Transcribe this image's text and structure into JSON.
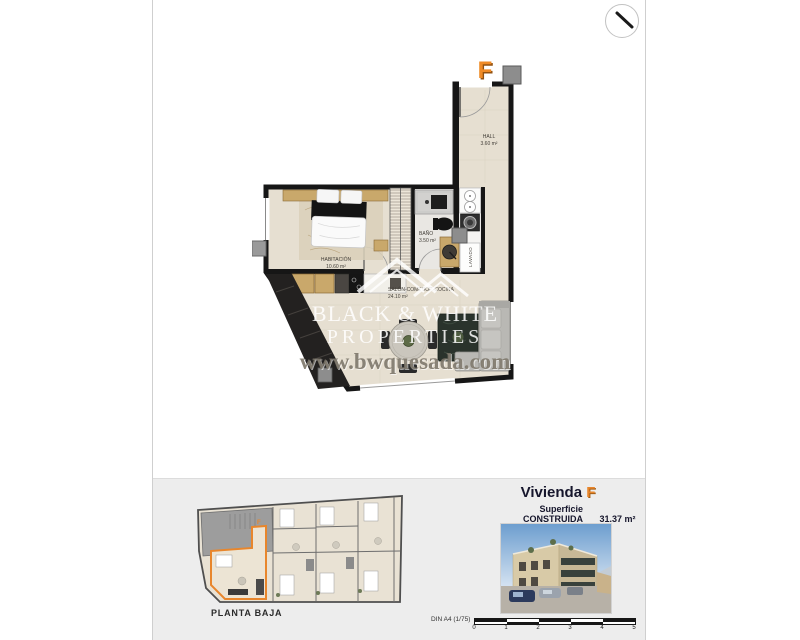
{
  "header": {
    "compass_icon": "north-arrow-icon"
  },
  "plan": {
    "unit_letter": "F",
    "rooms": {
      "hall": {
        "name": "HALL",
        "area": "3.60 m²"
      },
      "bano": {
        "name": "BAÑO",
        "area": "3.50 m²"
      },
      "habitacion": {
        "name": "HABITACIÓN",
        "area": "10.60 m²"
      },
      "salon": {
        "name": "SALÓN-COMEDOR-COCINA",
        "area": "24.10 m²"
      },
      "lavado": {
        "name": "LAVADO"
      }
    }
  },
  "watermark": {
    "brand_line1": "BLACK & WHITE",
    "brand_line2": "PROPERTIES",
    "website": "www.bwquesada.com"
  },
  "footer": {
    "floor_label": "PLANTA BAJA",
    "unit_name": "Vivienda",
    "unit_letter": "F",
    "surface_label": "Superficie CONSTRUIDA",
    "surface_value": "31.37 m²",
    "sheet_label": "DIN A4 (1/75)",
    "scale_ticks": [
      "0",
      "1",
      "2",
      "3",
      "4",
      "5"
    ]
  },
  "colors": {
    "accent_orange": "#e8862c",
    "wall": "#161616",
    "floor": "#e6dfd1",
    "panel_bg": "#ededed"
  }
}
